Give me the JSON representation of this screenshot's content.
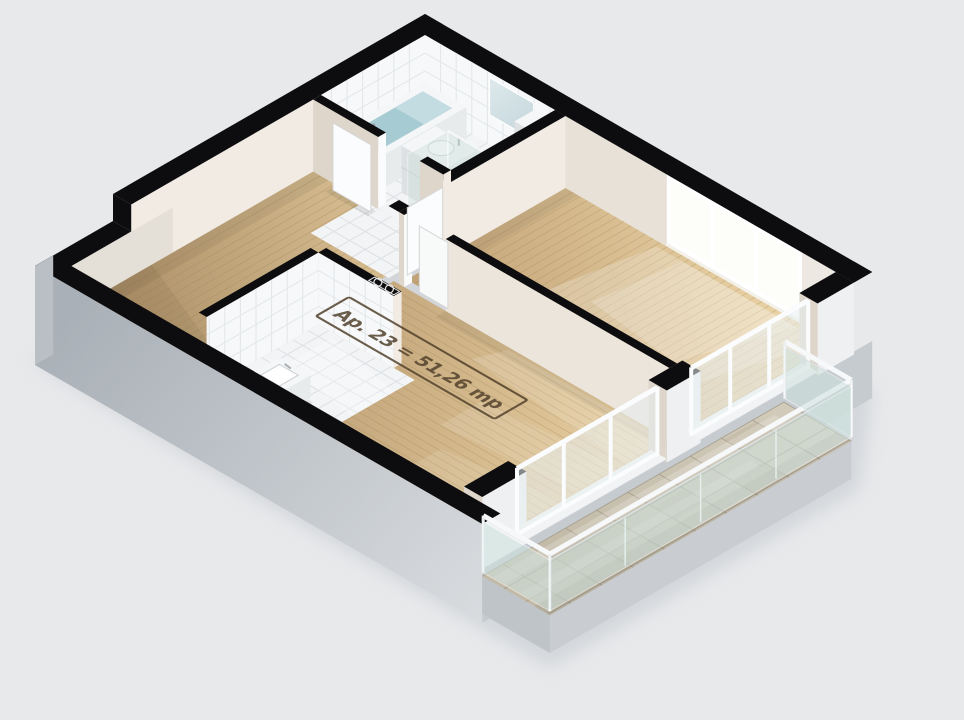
{
  "floor_stamp": {
    "text": "Ap. 23 = 51,26 mp",
    "apartment": "Ap. 23",
    "area": "51,26",
    "unit": "mp"
  },
  "scene": {
    "type": "isometric-3d-floor-plan-render",
    "rooms": [
      "bathroom",
      "hallway",
      "bedroom",
      "living-area",
      "kitchen",
      "balcony"
    ],
    "fixtures": [
      "bathtub",
      "washbasin-vanity",
      "toilet",
      "glass-shower-partition",
      "mirror",
      "wall-shelf",
      "kitchen-sink",
      "triple-pane-window",
      "balcony-french-doors",
      "glass-railing",
      "interior-doors",
      "cooktop-symbol"
    ]
  },
  "colors": {
    "background": "#e8e9eb",
    "ground_shadow": "#cdd1d6",
    "wall_cut_top": "#0d0d0f",
    "wall_face_light": "#f1ebe3",
    "wall_face_shade": "#ded6cb",
    "wall_face_medium": "#e8e1d8",
    "jamb_white": "#fafbfc",
    "tile_floor": "#f2f4f5",
    "tile_line": "#dcdfe3",
    "tile_wall": "#f6f8f9",
    "tile_wall_line": "#e2e6e9",
    "wood_light": "#e3ca9d",
    "wood_mid": "#cfb285",
    "wood_dark": "#b2946c",
    "wood_seam": "#a08858",
    "concrete_light": "#d7dadd",
    "concrete_dark": "#aab1b8",
    "paver": "#cec7b6",
    "paver_dark": "#bdb3a0",
    "paver_line": "#a49b89",
    "glass": "#cfe2de",
    "glass_edge": "#f4f7f6",
    "door_glass": "#e8eef0",
    "water": "#a6cbd3",
    "white_fixture": "#f4f6f7",
    "fixture_side": "#e8ebec",
    "fixture_front": "#dde1e3",
    "mirror_top": "#dbe7ea",
    "mirror_bottom": "#b7cdd4",
    "window_glow": "#fdfdfa",
    "stamp_ink": "#53422d"
  }
}
